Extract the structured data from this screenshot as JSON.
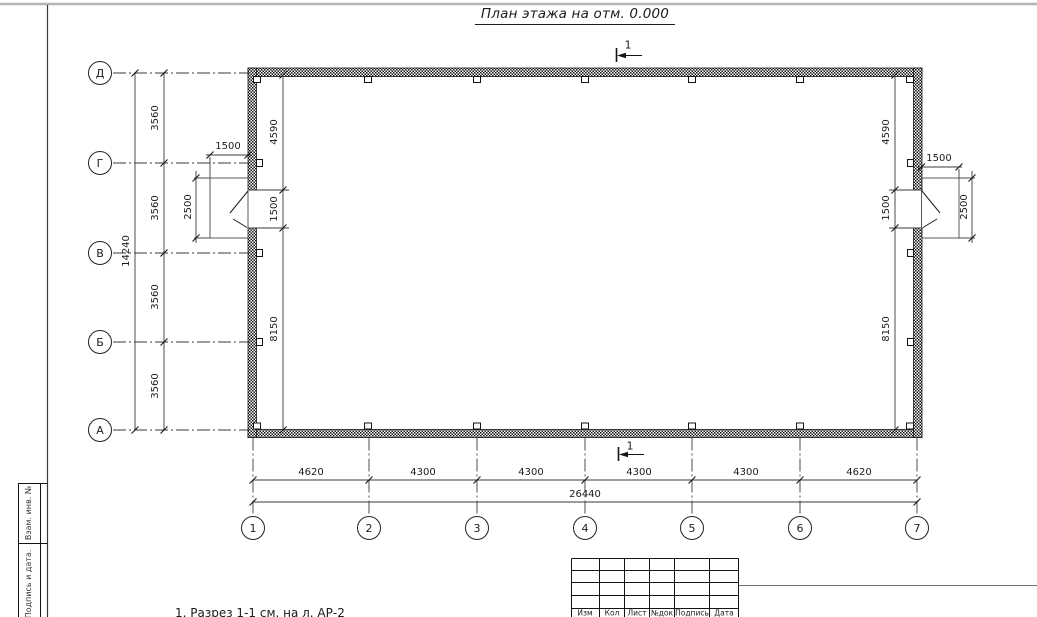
{
  "title": "План этажа на отм. 0.000",
  "section_mark": {
    "top_label": "1",
    "bottom_label": "1"
  },
  "axes": {
    "rows": [
      "Д",
      "Г",
      "В",
      "Б",
      "А"
    ],
    "cols": [
      "1",
      "2",
      "3",
      "4",
      "5",
      "6",
      "7"
    ]
  },
  "dims": {
    "row_span": [
      "3560",
      "3560",
      "3560",
      "3560"
    ],
    "row_total": "14240",
    "col_span": [
      "4620",
      "4300",
      "4300",
      "4300",
      "4300",
      "4620"
    ],
    "col_total": "26440",
    "inner_left": [
      "4590",
      "1500",
      "8150"
    ],
    "inner_right": [
      "4590",
      "1500",
      "8150"
    ],
    "door_left": {
      "width": "1500",
      "depth": "2500"
    },
    "door_right": {
      "width": "1500",
      "depth": "2500"
    }
  },
  "note": "1. Разрез 1-1 см. на л. АР-2",
  "title_block": {
    "headers": [
      "Изм",
      "Кол",
      "Лист",
      "№док",
      "Подпись",
      "Дата"
    ]
  },
  "margin_fields": [
    "Взам. инв. №",
    "Подпись и дата."
  ],
  "colors": {
    "ink": "#1c1c1c",
    "frame_gray": "#b5b5b5"
  }
}
